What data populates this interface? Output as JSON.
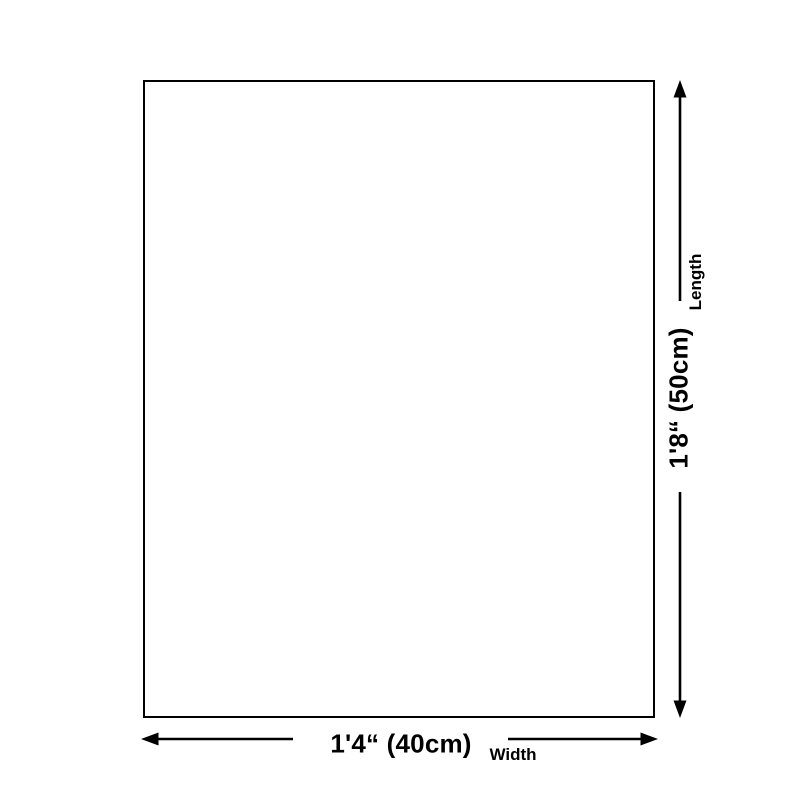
{
  "colors": {
    "background": "#ffffff",
    "line": "#000000",
    "text": "#000000"
  },
  "dimensions": {
    "width": {
      "value": "1'4“ (40cm)",
      "label": "Width"
    },
    "length": {
      "value": "1'8“ (50cm)",
      "label": "Length"
    }
  }
}
